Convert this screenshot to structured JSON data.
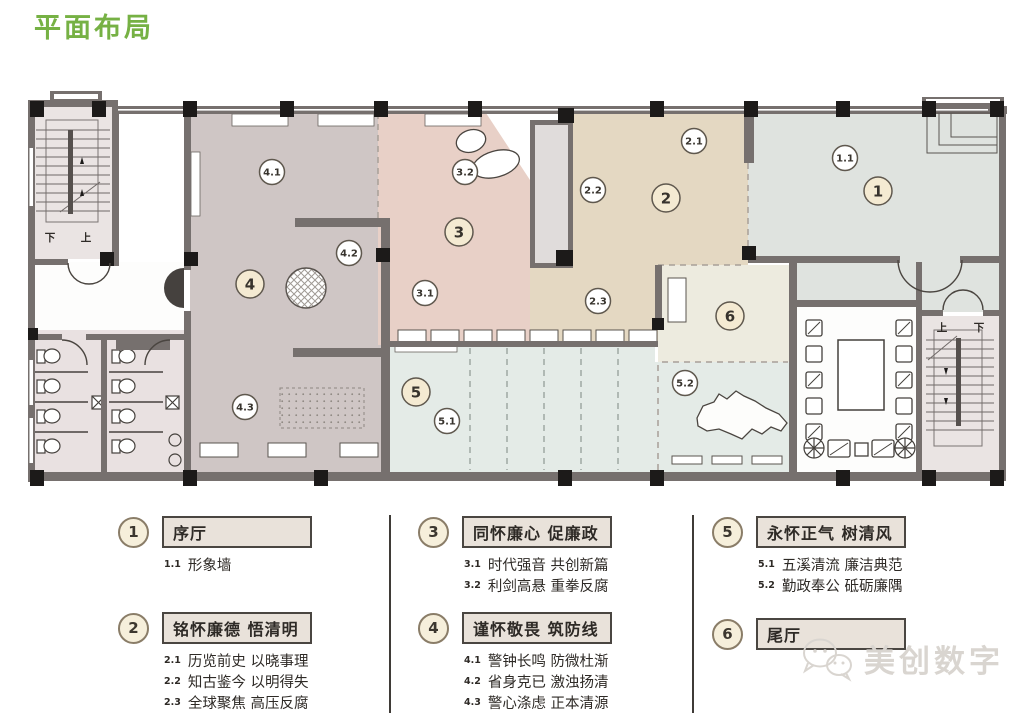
{
  "page": {
    "title": "平面布局",
    "title_color": "#76b144"
  },
  "watermark": {
    "text": "美创数字",
    "logo": "wechat-bubbles-icon"
  },
  "plan": {
    "stair_labels": [
      {
        "text": "下",
        "x": 50,
        "y": 241
      },
      {
        "text": "上",
        "x": 86,
        "y": 241
      },
      {
        "text": "上",
        "x": 942,
        "y": 331
      },
      {
        "text": "下",
        "x": 979,
        "y": 331
      }
    ],
    "markers": [
      {
        "label": "1",
        "x": 878,
        "y": 191,
        "major": true
      },
      {
        "label": "1.1",
        "x": 845,
        "y": 158,
        "major": false
      },
      {
        "label": "2",
        "x": 666,
        "y": 198,
        "major": true
      },
      {
        "label": "2.1",
        "x": 694,
        "y": 141,
        "major": false
      },
      {
        "label": "2.2",
        "x": 593,
        "y": 190,
        "major": false
      },
      {
        "label": "2.3",
        "x": 598,
        "y": 301,
        "major": false
      },
      {
        "label": "3",
        "x": 459,
        "y": 232,
        "major": true
      },
      {
        "label": "3.1",
        "x": 425,
        "y": 293,
        "major": false
      },
      {
        "label": "3.2",
        "x": 465,
        "y": 172,
        "major": false
      },
      {
        "label": "4",
        "x": 250,
        "y": 284,
        "major": true
      },
      {
        "label": "4.1",
        "x": 272,
        "y": 172,
        "major": false
      },
      {
        "label": "4.2",
        "x": 349,
        "y": 253,
        "major": false
      },
      {
        "label": "4.3",
        "x": 245,
        "y": 407,
        "major": false
      },
      {
        "label": "5",
        "x": 416,
        "y": 392,
        "major": true
      },
      {
        "label": "5.1",
        "x": 447,
        "y": 421,
        "major": false
      },
      {
        "label": "5.2",
        "x": 685,
        "y": 383,
        "major": false
      },
      {
        "label": "6",
        "x": 730,
        "y": 316,
        "major": true
      }
    ]
  },
  "legend": {
    "items": [
      {
        "num": "1",
        "title": "序厅",
        "subs": [
          {
            "num": "1.1",
            "text": "形象墙"
          }
        ]
      },
      {
        "num": "2",
        "title": "铭怀廉德 悟清明",
        "subs": [
          {
            "num": "2.1",
            "text": "历览前史 以晓事理"
          },
          {
            "num": "2.2",
            "text": "知古鉴今 以明得失"
          },
          {
            "num": "2.3",
            "text": "全球聚焦 高压反腐"
          }
        ]
      },
      {
        "num": "3",
        "title": "同怀廉心 促廉政",
        "subs": [
          {
            "num": "3.1",
            "text": "时代强音 共创新篇"
          },
          {
            "num": "3.2",
            "text": "利剑高悬 重拳反腐"
          }
        ]
      },
      {
        "num": "4",
        "title": "谨怀敬畏 筑防线",
        "subs": [
          {
            "num": "4.1",
            "text": "警钟长鸣 防微杜渐"
          },
          {
            "num": "4.2",
            "text": "省身克已 激浊扬清"
          },
          {
            "num": "4.3",
            "text": "警心涤虑 正本清源"
          }
        ]
      },
      {
        "num": "5",
        "title": "永怀正气 树清风",
        "subs": [
          {
            "num": "5.1",
            "text": "五溪清流 廉洁典范"
          },
          {
            "num": "5.2",
            "text": "勤政奉公 砥砺廉隅"
          }
        ]
      },
      {
        "num": "6",
        "title": "尾厅",
        "subs": []
      }
    ]
  }
}
